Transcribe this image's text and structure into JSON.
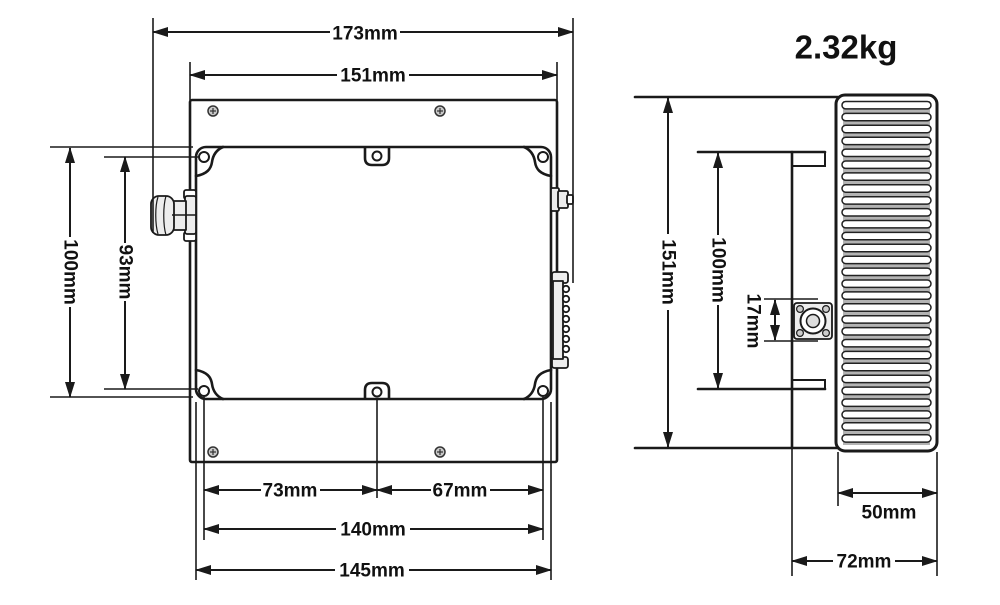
{
  "weight_label": "2.32kg",
  "front_view": {
    "dim_overall_width": "173mm",
    "dim_plate_width": "151mm",
    "dim_body_height": "100mm",
    "dim_hole_pitch_vertical": "93mm",
    "dim_hole_left_span": "73mm",
    "dim_hole_right_span": "67mm",
    "dim_hole_pitch_horizontal": "140mm",
    "dim_body_width": "145mm"
  },
  "side_view": {
    "dim_plate_height": "151mm",
    "dim_body_height": "100mm",
    "dim_connector_size": "17mm",
    "dim_heatsink_depth": "50mm",
    "dim_overall_depth": "72mm"
  }
}
